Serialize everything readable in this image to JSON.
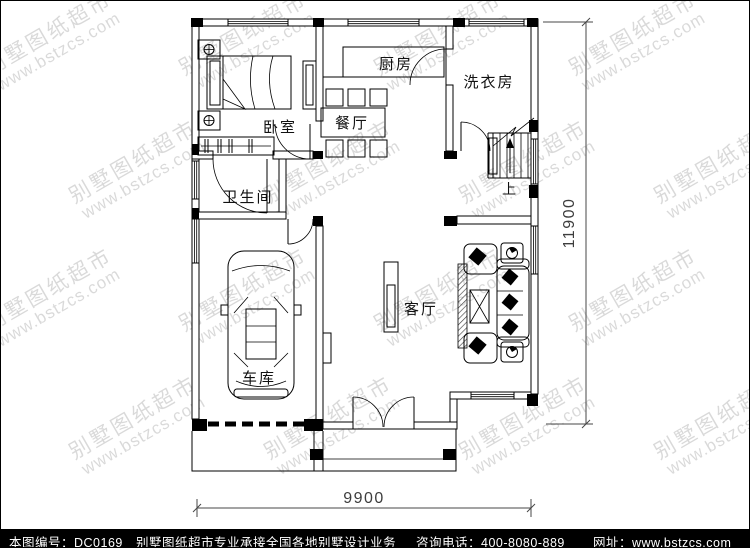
{
  "plan": {
    "rooms": {
      "bedroom": "卧室",
      "kitchen": "厨房",
      "laundry": "洗衣房",
      "dining": "餐厅",
      "bathroom": "卫生间",
      "living": "客厅",
      "garage": "车库",
      "stairs_up": "上"
    },
    "dimensions": {
      "width": "9900",
      "height": "11900"
    }
  },
  "watermark": {
    "line1": "别墅图纸超市",
    "line2": "www.bstzcs.com"
  },
  "footer": {
    "drawing_no": "本图编号：DC0169",
    "slogan": "别墅图纸超市专业承接全国各地别墅设计业务",
    "phone": "咨询电话：400-8080-889",
    "website": "网址：www.bstzcs.com"
  },
  "colors": {
    "line": "#000000",
    "watermark": "#d4d4d4",
    "footer_bg": "#000000",
    "footer_text": "#ffffff"
  }
}
